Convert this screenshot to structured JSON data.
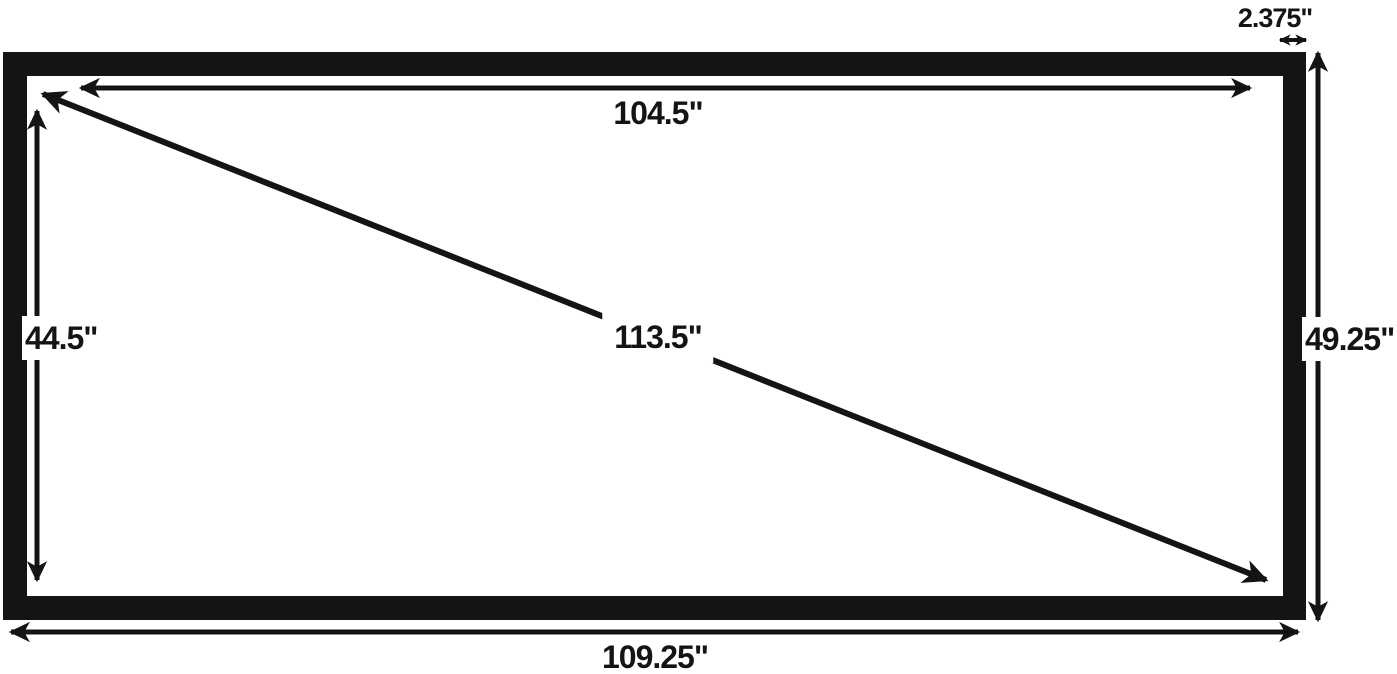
{
  "diagram": {
    "colors": {
      "background": "#ffffff",
      "ink": "#141414"
    },
    "dimensions": {
      "viewable_width": {
        "label": "104.5\"",
        "value": 104.5
      },
      "viewable_height": {
        "label": "44.5\"",
        "value": 44.5
      },
      "overall_width": {
        "label": "109.25\"",
        "value": 109.25
      },
      "overall_height": {
        "label": "49.25\"",
        "value": 49.25
      },
      "diagonal": {
        "label": "113.5\"",
        "value": 113.5
      },
      "frame_width": {
        "label": "2.375\"",
        "value": 2.375
      }
    }
  }
}
